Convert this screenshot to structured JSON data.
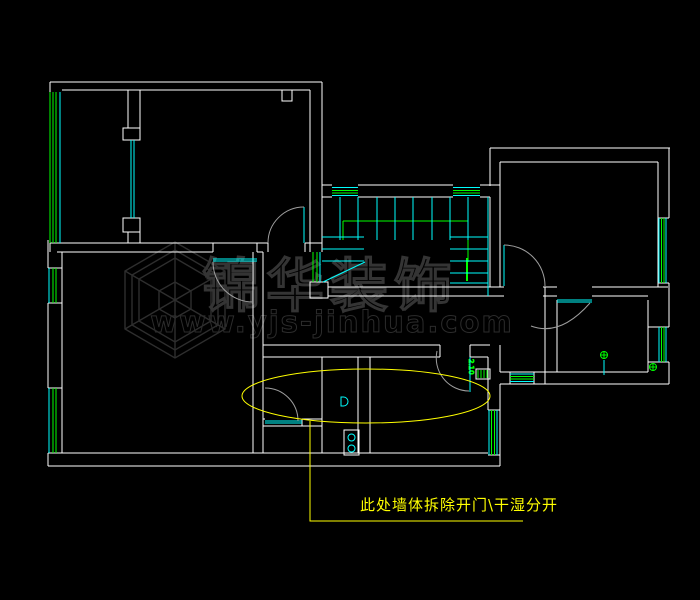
{
  "colors": {
    "background": "#000000",
    "wall": "#ffffff",
    "window": "#00ff00",
    "fixture": "#00ffff",
    "door_arc": "#9e9e9e",
    "highlight": "#ffff00",
    "watermark": "#2e2e2e"
  },
  "watermark": {
    "brand": "锦华装饰",
    "url": "www.yjs-jinhua.com"
  },
  "annotation": {
    "text": "此处墙体拆除开门\\干湿分开"
  },
  "labels": {
    "door_height": "2.10"
  },
  "fixtures": {
    "stove": "two-burner-stove",
    "drain": "floor-drain",
    "toilet": "wall-fixture-d",
    "stair": "u-shaped-staircase"
  }
}
